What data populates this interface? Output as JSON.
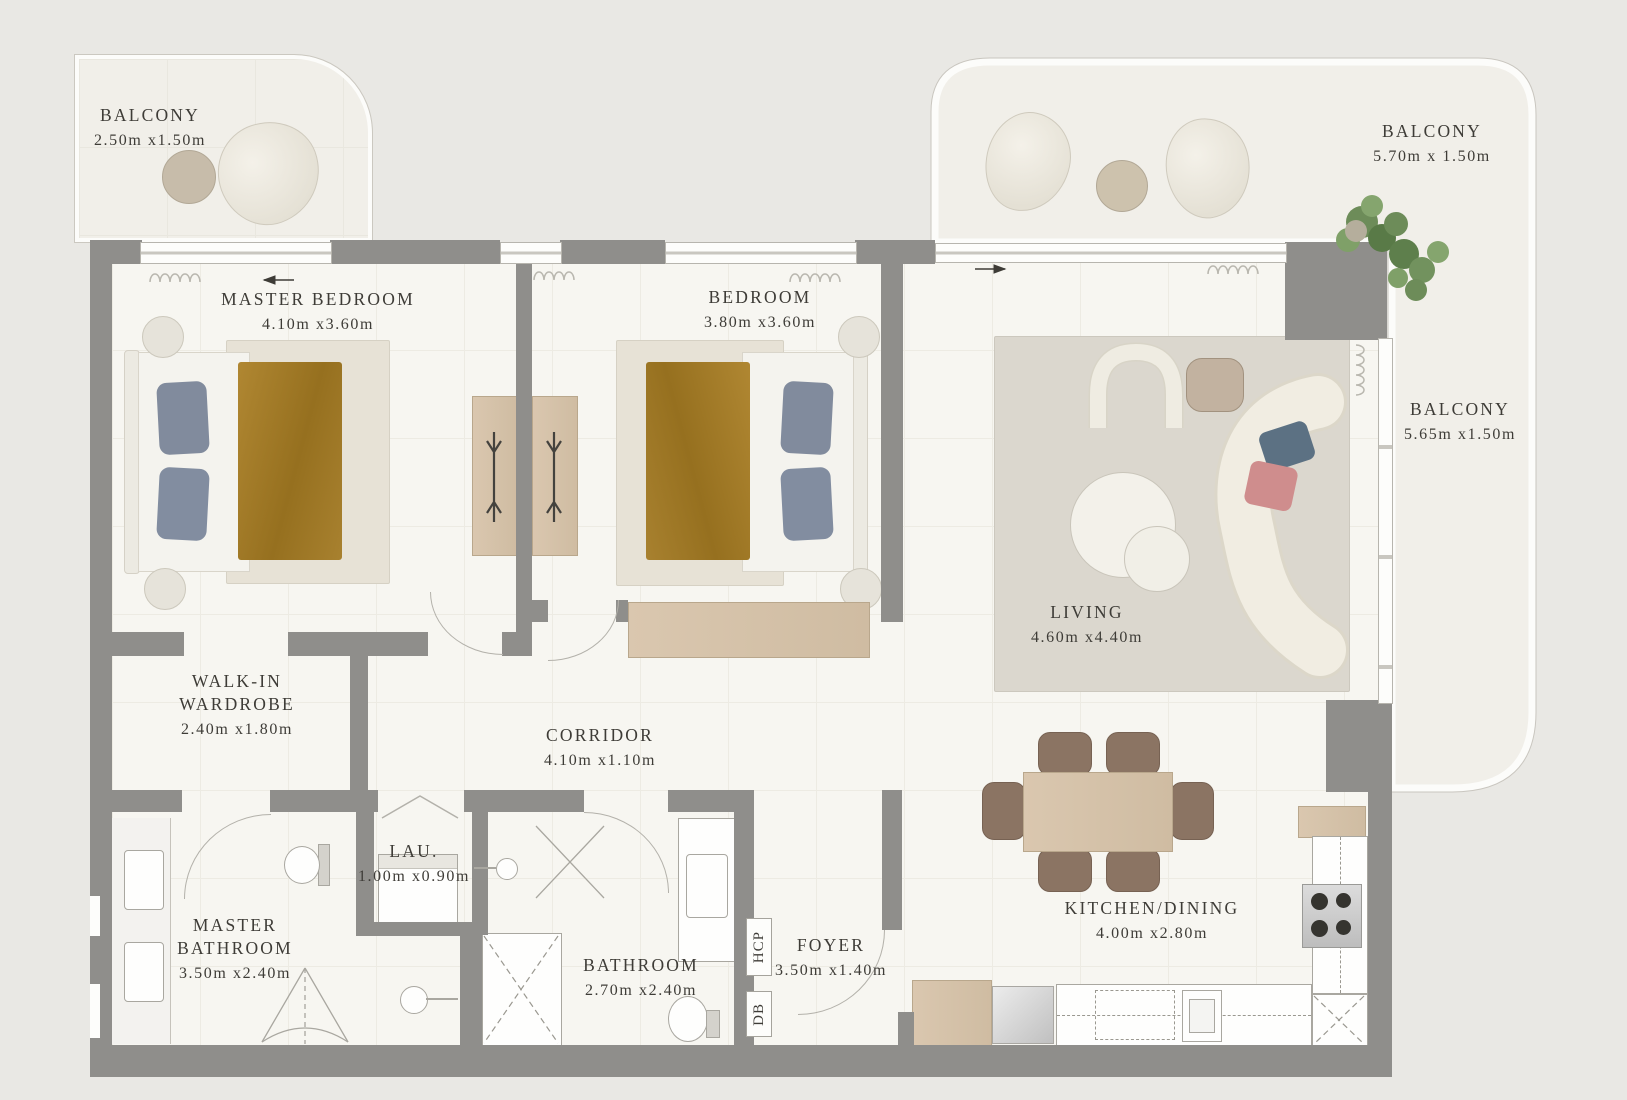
{
  "rooms": [
    {
      "name": "BALCONY",
      "dims": "2.50m x1.50m"
    },
    {
      "name": "MASTER BEDROOM",
      "dims": "4.10m x3.60m"
    },
    {
      "name": "BEDROOM",
      "dims": "3.80m x3.60m"
    },
    {
      "name": "BALCONY",
      "dims": "5.70m x 1.50m"
    },
    {
      "name": "BALCONY",
      "dims": "5.65m x1.50m"
    },
    {
      "name": "LIVING",
      "dims": "4.60m x4.40m"
    },
    {
      "name": "WALK-IN WARDROBE",
      "dims": "2.40m x1.80m"
    },
    {
      "name": "CORRIDOR",
      "dims": "4.10m x1.10m"
    },
    {
      "name": "LAU.",
      "dims": "1.00m x0.90m"
    },
    {
      "name": "MASTER BATHROOM",
      "dims": "3.50m x2.40m"
    },
    {
      "name": "BATHROOM",
      "dims": "2.70m x2.40m"
    },
    {
      "name": "FOYER",
      "dims": "3.50m x1.40m"
    },
    {
      "name": "KITCHEN/DINING",
      "dims": "4.00m x2.80m"
    }
  ],
  "wall_labels": [
    "HCP",
    "DB"
  ],
  "colors": {
    "wall": "#8f8e8b",
    "floor": "#f7f6f1",
    "balcony_floor": "#f1efe9",
    "background": "#e9e8e4",
    "wood": "#d8c5ac",
    "blanket": "#a87f2c",
    "pillow": "#818b9d",
    "dining_chair": "#8b7463",
    "text": "#3e3c37",
    "plant": "#6d8c59",
    "accent_pillow_teal": "#5c7183",
    "accent_pillow_pink": "#cf8d8d"
  }
}
